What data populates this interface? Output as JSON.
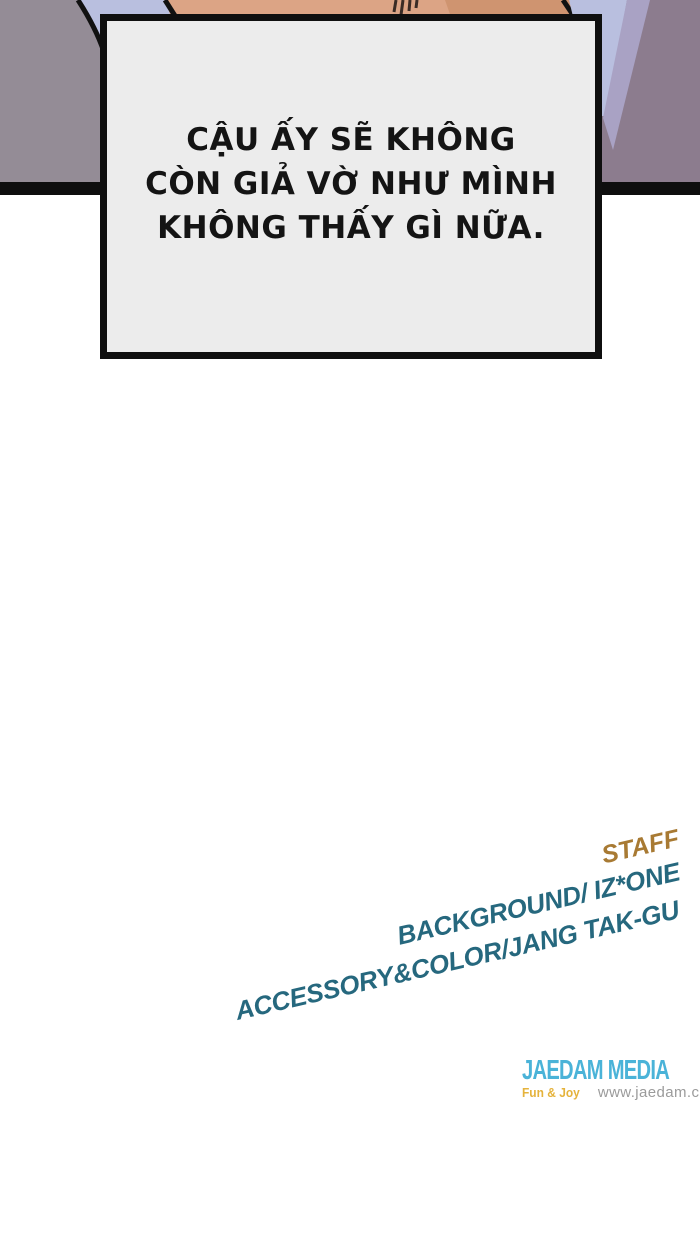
{
  "panel": {
    "speech_lines": {
      "l1": "CẬU ẤY SẼ KHÔNG",
      "l2": "CÒN GIẢ VỜ NHƯ MÌNH",
      "l3": "KHÔNG THẤY GÌ NỮA."
    },
    "colors": {
      "wall_left": "#948c96",
      "wall_right": "#8c7c8e",
      "wall_streak": "#a9a2c4",
      "shirt": "#b9bfdf",
      "skin": "#dca485",
      "skin_shadow": "#cf9470",
      "hair_strand": "#3a2b25",
      "outline": "#111111",
      "panel_border": "#0e0e0e"
    }
  },
  "credits": {
    "staff_label": "STAFF",
    "background_line": "BACKGROUND/ IZ*ONE",
    "accessory_line": "ACCESSORY&COLOR/JANG TAK-GU",
    "colors": {
      "staff": "#a87a33",
      "line": "#26687e"
    }
  },
  "publisher": {
    "name": "JAEDAM MEDIA",
    "tagline": "Fun & Joy",
    "website": "www.jaedam.com",
    "colors": {
      "name": "#4ab3d8",
      "tagline": "#e5b33c",
      "website": "#9b9b9b"
    }
  }
}
